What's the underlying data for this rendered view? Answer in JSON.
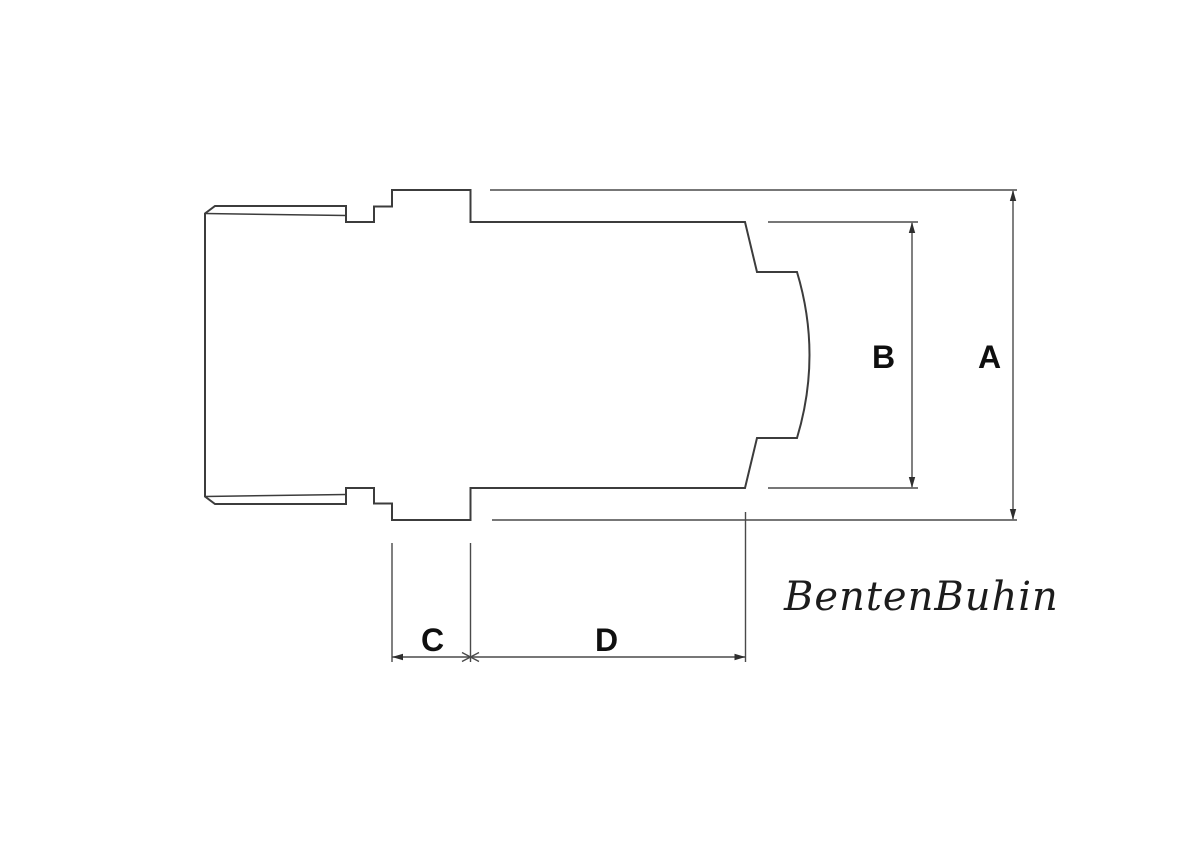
{
  "drawing": {
    "type": "technical-dimension-drawing",
    "dimensions": {
      "a": {
        "label": "A"
      },
      "b": {
        "label": "B"
      },
      "c": {
        "label": "C"
      },
      "d": {
        "label": "D"
      }
    },
    "watermark": {
      "text": "BentenBuhin"
    },
    "colors": {
      "background": "#ffffff",
      "part_line": "#3c3c3c",
      "dimension_line": "#4a4a4a",
      "label_text": "#0f0f0f"
    }
  }
}
